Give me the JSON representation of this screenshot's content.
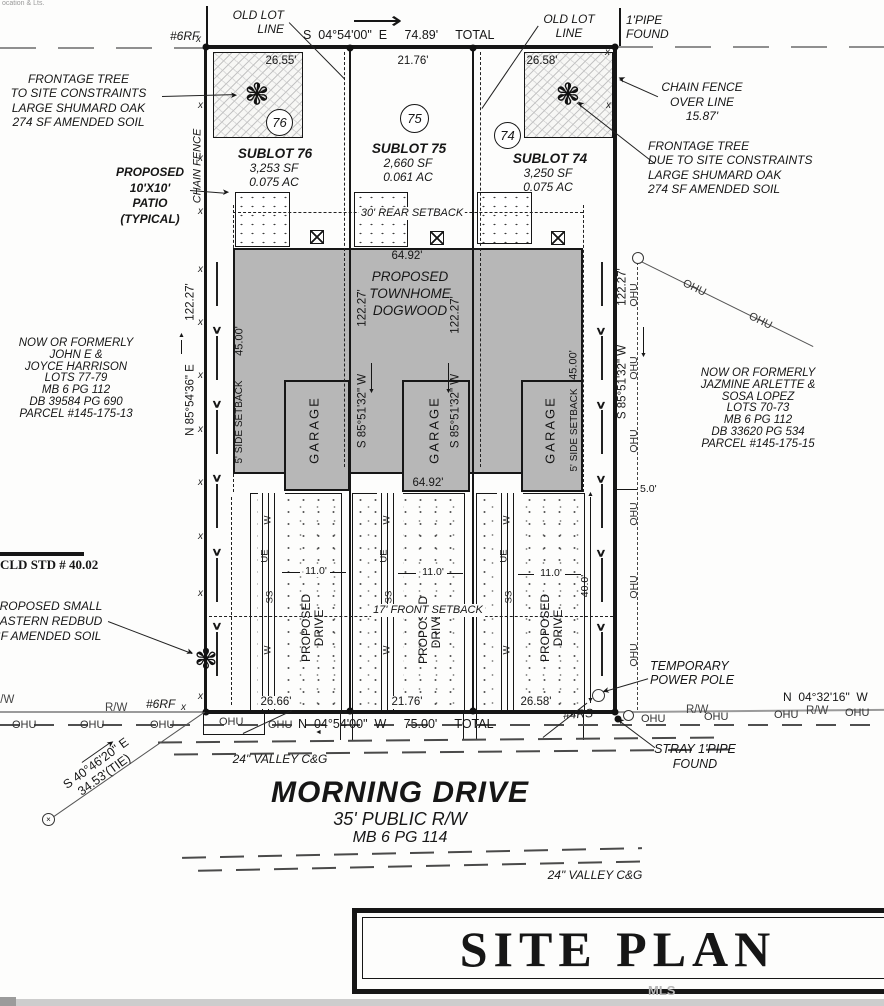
{
  "meta": {
    "corner_fragment": "ocation & Lts.",
    "watermark": "MLS"
  },
  "titleblock": {
    "title": "SITE PLAN"
  },
  "street": {
    "name": "MORNING DRIVE",
    "row": "35' PUBLIC R/W",
    "plat": "MB 6 PG 114",
    "gutter1": "24\" VALLEY C&G",
    "gutter2": "24\" VALLEY C&G"
  },
  "bearings": {
    "top": "S  04°54'00\"  E     74.89'     TOTAL",
    "bottom": "N  04°54'00\"  W     75.00'     TOTAL",
    "left": "N 85°54'36\" E",
    "left_dist": "122.27'",
    "mid": "S 85°51'32\" W",
    "mid_dist": "122.27'",
    "right": "S 85°51'32\" W",
    "right_dist": "122.27'",
    "street_right": "N  04°32'16\"  W",
    "tie1": "S 40°46'20\" E",
    "tie2": "34.53'(TIE)"
  },
  "sublots": [
    {
      "number": "76",
      "name": "SUBLOT 76",
      "sf": "3,253 SF",
      "ac": "0.075 AC",
      "front": "26.55'",
      "rear": "26.66'"
    },
    {
      "number": "75",
      "name": "SUBLOT 75",
      "sf": "2,660 SF",
      "ac": "0.061 AC",
      "front": "21.76'",
      "rear": "21.76'"
    },
    {
      "number": "74",
      "name": "SUBLOT 74",
      "sf": "3,250 SF",
      "ac": "0.075 AC",
      "front": "26.58'",
      "rear": "26.58'"
    }
  ],
  "building": {
    "lines": [
      "PROPOSED",
      "TOWNHOME",
      "DOGWOOD"
    ],
    "w_top": "64.92'",
    "w_bot": "64.92'",
    "garage": "GARAGE",
    "depth": "45.00'"
  },
  "setbacks": {
    "rear": "30' REAR SETBACK",
    "front": "17' FRONT SETBACK",
    "side": "5' SIDE SETBACK",
    "side_gap": "5.0'"
  },
  "drives": {
    "lines": [
      "PROPOSED",
      "DRIVE"
    ],
    "width": "11.0'",
    "depth": "40.0'",
    "u1": "W",
    "u2": "UE",
    "u3": "SS",
    "u4": "W"
  },
  "notes": {
    "frontage_left": [
      "FRONTAGE TREE",
      "TO SITE CONSTRAINTS",
      "LARGE SHUMARD OAK",
      "274 SF AMENDED SOIL"
    ],
    "patio": [
      "PROPOSED",
      "10'X10'",
      "PATIO",
      "(TYPICAL)"
    ],
    "chain_fence": "CHAIN FENCE",
    "old_lot": [
      "OLD LOT",
      "LINE"
    ],
    "pipe_found": [
      "1'PIPE",
      "FOUND"
    ],
    "chain_over": [
      "CHAIN FENCE",
      "OVER LINE",
      "15.87'"
    ],
    "frontage_right": [
      "FRONTAGE TREE",
      "DUE TO SITE CONSTRAINTS",
      "LARGE SHUMARD OAK",
      "274 SF AMENDED SOIL"
    ],
    "owner_left": [
      "NOW OR FORMERLY",
      "JOHN E &",
      "JOYCE HARRISON",
      "LOTS 77-79",
      "MB 6 PG 112",
      "DB 39584 PG 690",
      "PARCEL #145-175-13"
    ],
    "owner_right": [
      "NOW OR FORMERLY",
      "JAZMINE ARLETTE &",
      "SOSA LOPEZ",
      "LOTS 70-73",
      "MB 6 PG 112",
      "DB 33620 PG 534",
      "PARCEL #145-175-15"
    ],
    "cld": "CLD STD # 40.02",
    "redbud": [
      "PROPOSED SMALL",
      "EASTERN REDBUD",
      "SF AMENDED SOIL"
    ],
    "temp_pole": [
      "TEMPORARY",
      "POWER POLE"
    ],
    "stray": [
      "STRAY 1'PIPE",
      "FOUND"
    ]
  },
  "markers": {
    "rf6": "#6RF",
    "rs4": "#4RS",
    "rw": "R/W",
    "ohu": "OHU"
  },
  "icons": {
    "tree": "❃",
    "chevron": "∨",
    "fence_mark": "x",
    "arrow_long": "⟶",
    "arrow_head": "➤",
    "arrow_up": "▲",
    "arrow_down": "▼",
    "arrow_left": "◄",
    "monument_cross": "×"
  }
}
